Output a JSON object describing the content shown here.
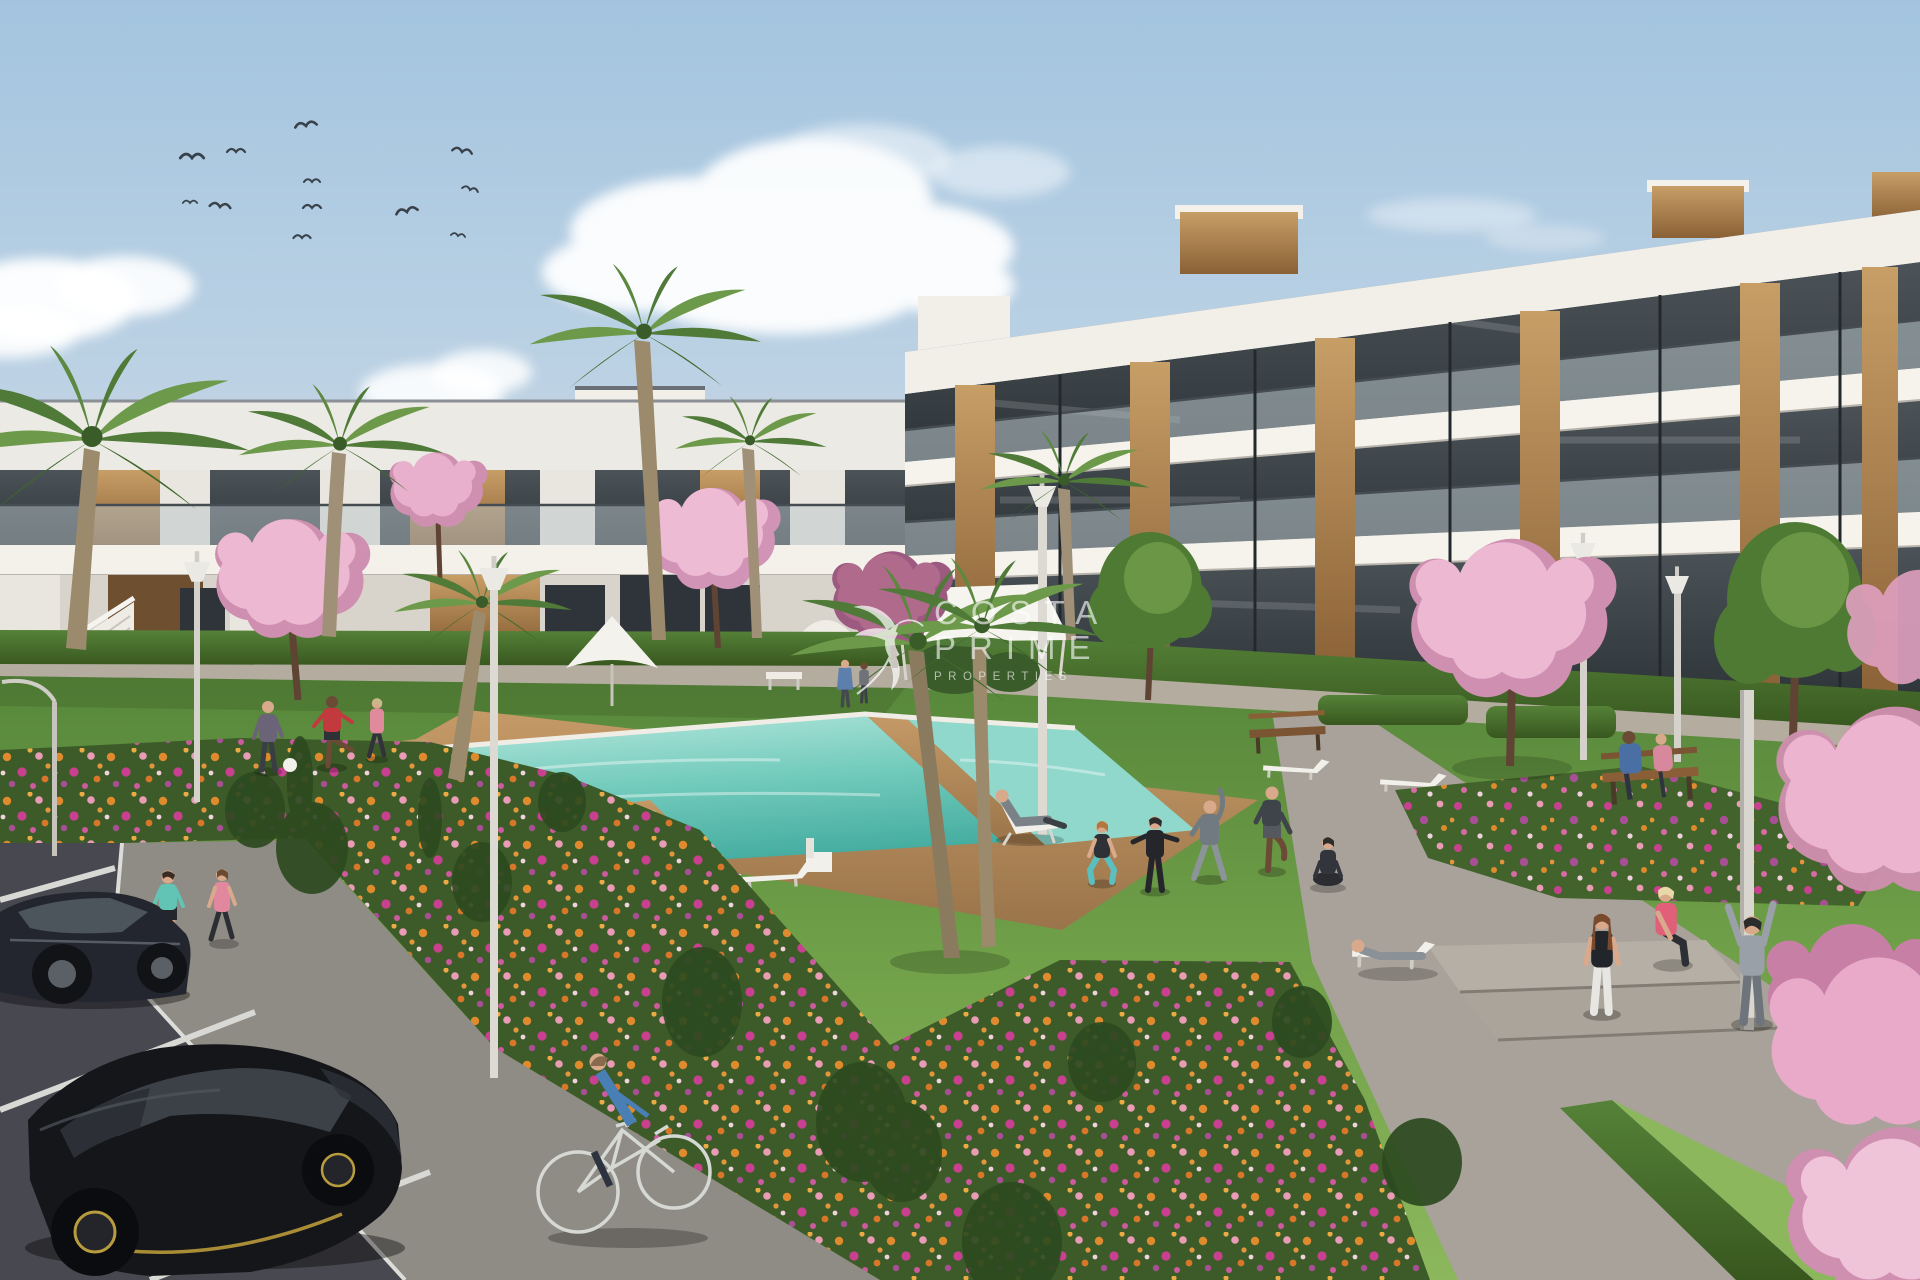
{
  "watermark": {
    "logo_icon": "hummingbird-logo",
    "lines": [
      "COSTA",
      "PRIME",
      "PROPERTIES"
    ],
    "color": "#ffffff",
    "opacity": 0.78
  },
  "scene": {
    "description": "Sunny 3D architectural render of a modern white resort-style apartment complex: communal pool with wooden deck, lawns with residents exercising, palm and cherry-blossom trees, flower beds, street lamps, parking lot with two black cars and a passing cyclist",
    "counts": {
      "birds": 12,
      "clouds": 4,
      "palm_trees": 8,
      "blossom_trees": 6,
      "lampposts": 7,
      "sun_loungers": 8,
      "benches": 3,
      "people": 18,
      "cars": 2,
      "bicycles": 1,
      "pools": 2
    },
    "palette": {
      "sky_top": "#a6c6e0",
      "sky_horizon": "#e6dbca",
      "building_white": "#f2efe9",
      "building_shade": "#ddd8d0",
      "wood_accent": "#b9905a",
      "wood_dark": "#6e4f30",
      "glass_dark": "#3c4347",
      "balustrade_glass": "#b9c6cc",
      "lawn_green": "#6f9f48",
      "hedge_green": "#47702f",
      "flower_orange": "#e08a2e",
      "flower_magenta": "#c94090",
      "flower_pink": "#ea9cb6",
      "blossom_pink": "#edb9d2",
      "blossom_deep": "#cf8fb0",
      "pool_turquoise": "#5fc3b4",
      "pool_shallow": "#b8e7de",
      "deck_wood": "#c59a67",
      "pavement_light": "#a8a29a",
      "pavement_mid": "#8f8b85",
      "asphalt_dark": "#474850",
      "car_black": "#15161a",
      "car_accent_yellow": "#c2a23c"
    }
  }
}
